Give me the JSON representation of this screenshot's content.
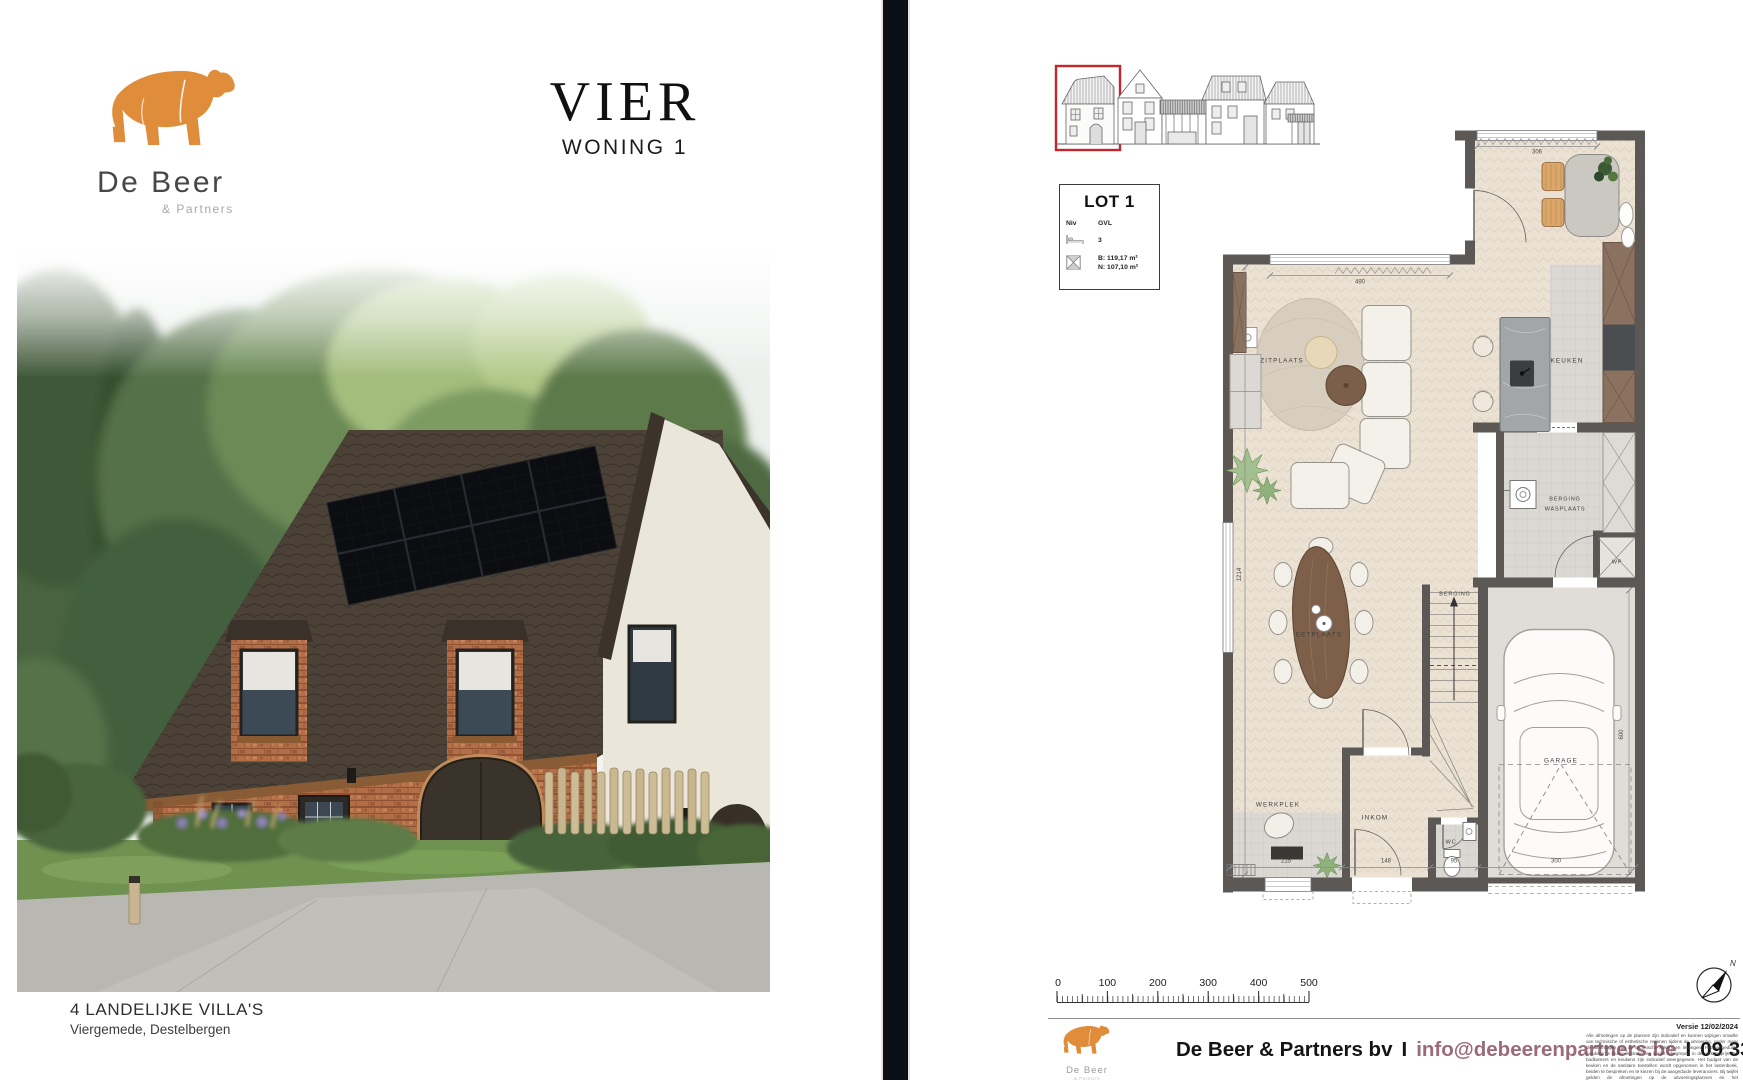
{
  "page": {
    "bg": "#ffffff",
    "divider_color": "#0a0e15"
  },
  "left": {
    "logo": {
      "brand": "De Beer",
      "suffix": "& Partners",
      "bear_color": "#DF8C3B"
    },
    "title": {
      "main": "VIER",
      "sub": "WONING 1"
    },
    "photo": {
      "label_left": "4a",
      "label_right": "4b"
    },
    "caption": {
      "line1": "4 LANDELIJKE VILLA'S",
      "line2": "Viergemede, Destelbergen"
    }
  },
  "right": {
    "lot": {
      "title": "LOT 1",
      "niv_label": "Niv",
      "niv_value": "GVL",
      "bedrooms": "3",
      "area_b": "B: 119,17 m²",
      "area_n": "N: 107,10 m²"
    },
    "plan": {
      "rooms": {
        "zitplaats": "ZITPLAATS",
        "keuken": "KEUKEN",
        "berging1": "BERGING",
        "wasplaats": "WASPLAATS",
        "eetplaats": "EETPLAATS",
        "berging2": "BERGING",
        "garage": "GARAGE",
        "werkplek": "WERKPLEK",
        "inkom": "INKOM",
        "wc": "WC",
        "wp": "WP"
      },
      "dims": {
        "d490": "490",
        "d306": "306",
        "d1214": "1214",
        "d215": "215",
        "d148": "148",
        "d95": "95",
        "d300": "300",
        "d600": "600"
      }
    },
    "scalebar": {
      "l0": "0",
      "l1": "100",
      "l2": "200",
      "l3": "300",
      "l4": "400",
      "l5": "500"
    },
    "compass": {
      "north": "N"
    },
    "footer": {
      "company": "De Beer & Partners bv",
      "sep": "I",
      "email": "info@debeerenpartners.be",
      "phone": "09 336 33 30",
      "logo_brand": "De Beer",
      "logo_sub": "& Partners",
      "version": "Versie 12/02/2024",
      "disclaimer": "Alle afmetingen op de plannen zijn indicatief en kunnen wijzigen omwille van technische of esthetische redenen tijdens de uitvoering, onder meer de afmetingen van de technische kokers en leidingen. Het aangeduide meubilair is louter illustratief en is niet inbegrepen in de verkoopprijs. De badkamers en keukens zijn indicatief weergegeven. Het budget van de keuken en de sanitaire toestellen wordt opgenomen in het lastenboek, beiden te bespreken en te kiezen bij de aangeduide leveranciers. Bij twijfel gelden de afmetingen op de uitvoeringsplannen en het verkoopslastenboek."
    }
  }
}
